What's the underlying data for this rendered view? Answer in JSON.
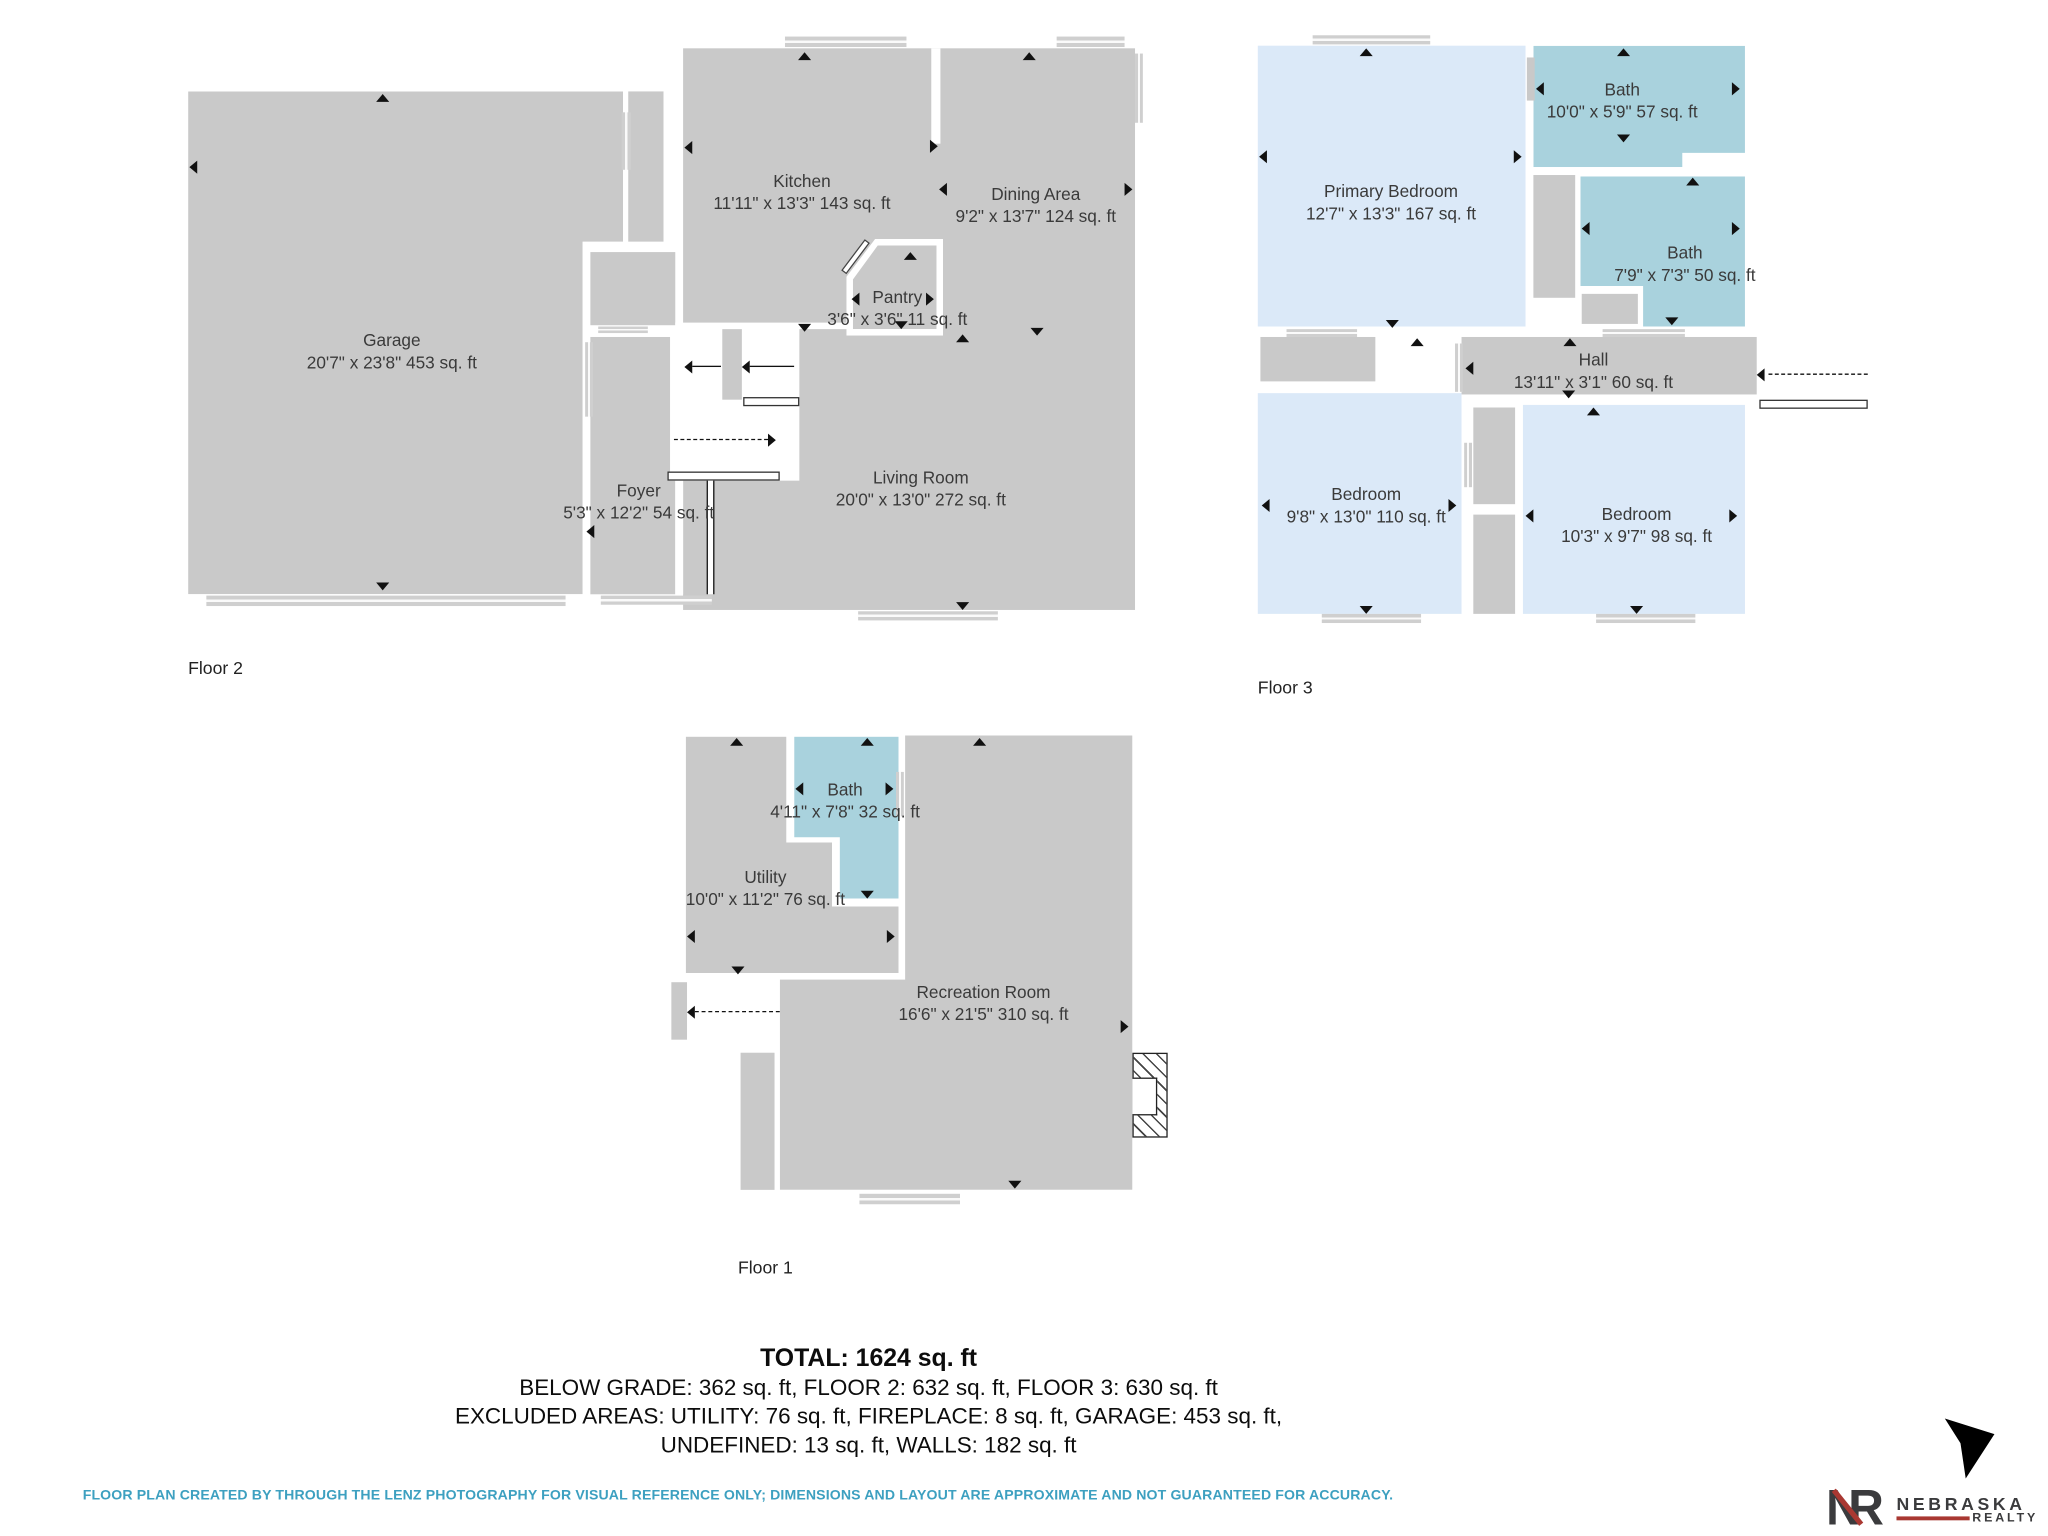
{
  "floors": [
    {
      "label": "Floor 2",
      "rooms": [
        {
          "name": "Garage",
          "dims": "20'7\" x 23'8\" 453 sq. ft"
        },
        {
          "name": "Kitchen",
          "dims": "11'11\" x 13'3\" 143 sq. ft"
        },
        {
          "name": "Dining Area",
          "dims": "9'2\" x 13'7\" 124 sq. ft"
        },
        {
          "name": "Pantry",
          "dims": "3'6\" x 3'6\" 11 sq. ft"
        },
        {
          "name": "Foyer",
          "dims": "5'3\" x 12'2\" 54 sq. ft"
        },
        {
          "name": "Living Room",
          "dims": "20'0\" x 13'0\" 272 sq. ft"
        }
      ]
    },
    {
      "label": "Floor 3",
      "rooms": [
        {
          "name": "Primary Bedroom",
          "dims": "12'7\" x 13'3\" 167 sq. ft"
        },
        {
          "name": "Bath",
          "dims": "10'0\" x 5'9\" 57 sq. ft"
        },
        {
          "name": "Bath",
          "dims": "7'9\" x 7'3\" 50 sq. ft"
        },
        {
          "name": "Hall",
          "dims": "13'11\" x 3'1\" 60 sq. ft"
        },
        {
          "name": "Bedroom",
          "dims": "9'8\" x 13'0\" 110 sq. ft"
        },
        {
          "name": "Bedroom",
          "dims": "10'3\" x 9'7\" 98 sq. ft"
        }
      ]
    },
    {
      "label": "Floor 1",
      "rooms": [
        {
          "name": "Bath",
          "dims": "4'11\" x 7'8\" 32 sq. ft"
        },
        {
          "name": "Utility",
          "dims": "10'0\" x 11'2\" 76 sq. ft"
        },
        {
          "name": "Recreation Room",
          "dims": "16'6\" x 21'5\" 310 sq. ft"
        }
      ]
    }
  ],
  "summary": {
    "total": "TOTAL: 1624 sq. ft",
    "line2": "BELOW GRADE: 362 sq. ft, FLOOR 2: 632 sq. ft, FLOOR 3: 630 sq. ft",
    "line3": "EXCLUDED AREAS: UTILITY: 76 sq. ft, FIREPLACE: 8 sq. ft, GARAGE: 453 sq. ft,",
    "line4": "UNDEFINED: 13 sq. ft, WALLS: 182 sq. ft"
  },
  "disclaimer": "FLOOR PLAN CREATED BY THROUGH THE LENZ PHOTOGRAPHY FOR VISUAL REFERENCE ONLY; DIMENSIONS AND LAYOUT ARE APPROXIMATE AND NOT GUARANTEED FOR ACCURACY.",
  "logo": {
    "monogram_n": "N",
    "monogram_r": "R",
    "brand": "NEBRASKA",
    "sub": "REALTY"
  },
  "colors": {
    "room_gray": "#c9c9c9",
    "bedroom_blue": "#dbe9f8",
    "bath_teal": "#a9d2dd",
    "window_gray": "#cfcfcf",
    "accent_red": "#a93832",
    "disclaimer_teal": "#3da0c0",
    "logo_gray": "#3b3b3d"
  }
}
